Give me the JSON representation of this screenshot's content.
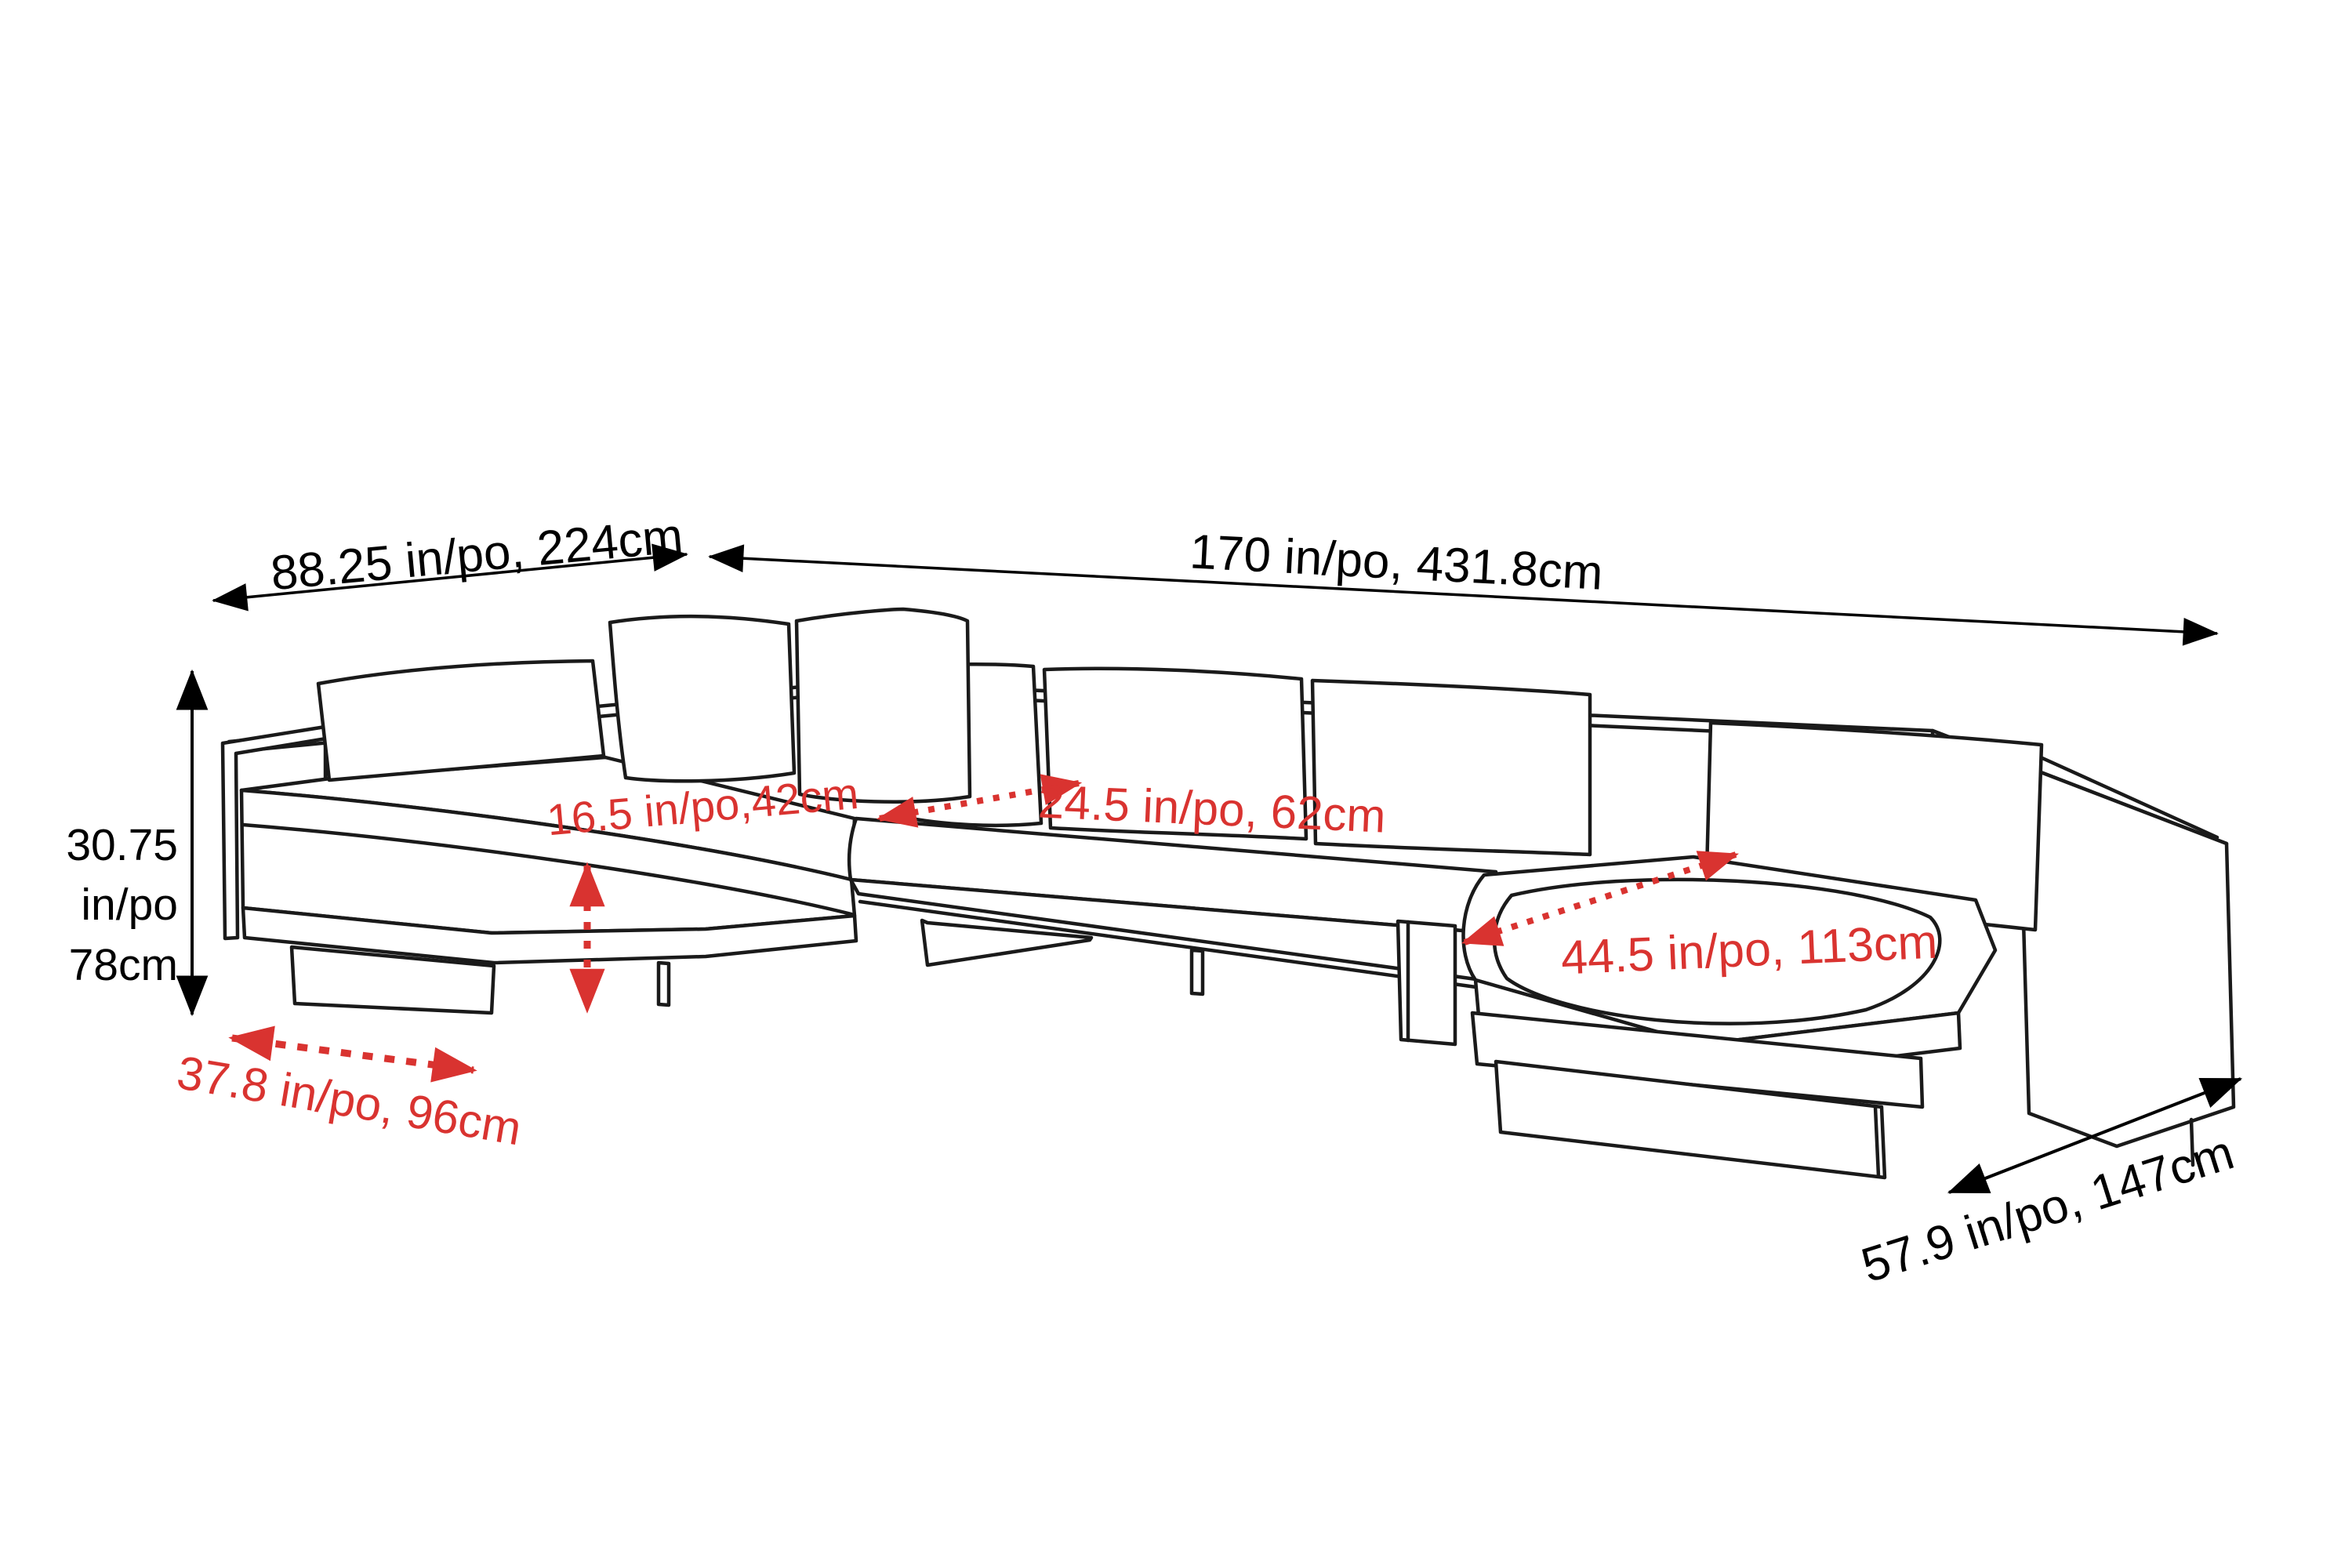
{
  "diagram": {
    "description": "Sectional sofa line drawing with dimension annotations",
    "units_note": "in/po = inches/pouces, cm = centimeters"
  },
  "colors": {
    "line_art": "#1a1a1a",
    "dimension_black": "#000000",
    "dimension_red": "#d93330",
    "background": "#ffffff"
  },
  "dimensions": {
    "left_section_width": {
      "label": "88.25 in/po, 224cm"
    },
    "total_width": {
      "label": "170 in/po, 431.8cm"
    },
    "overall_height": {
      "line1": "30.75",
      "line2": "in/po",
      "line3": "78cm"
    },
    "seat_height": {
      "label": "16.5 in/po,42cm"
    },
    "seat_depth": {
      "label": "24.5 in/po, 62cm"
    },
    "chaise_seat_width": {
      "label": "44.5 in/po, 113cm"
    },
    "left_section_depth": {
      "label": "37.8 in/po, 96cm"
    },
    "chaise_depth": {
      "label": "57.9 in/po, 147cm"
    }
  }
}
